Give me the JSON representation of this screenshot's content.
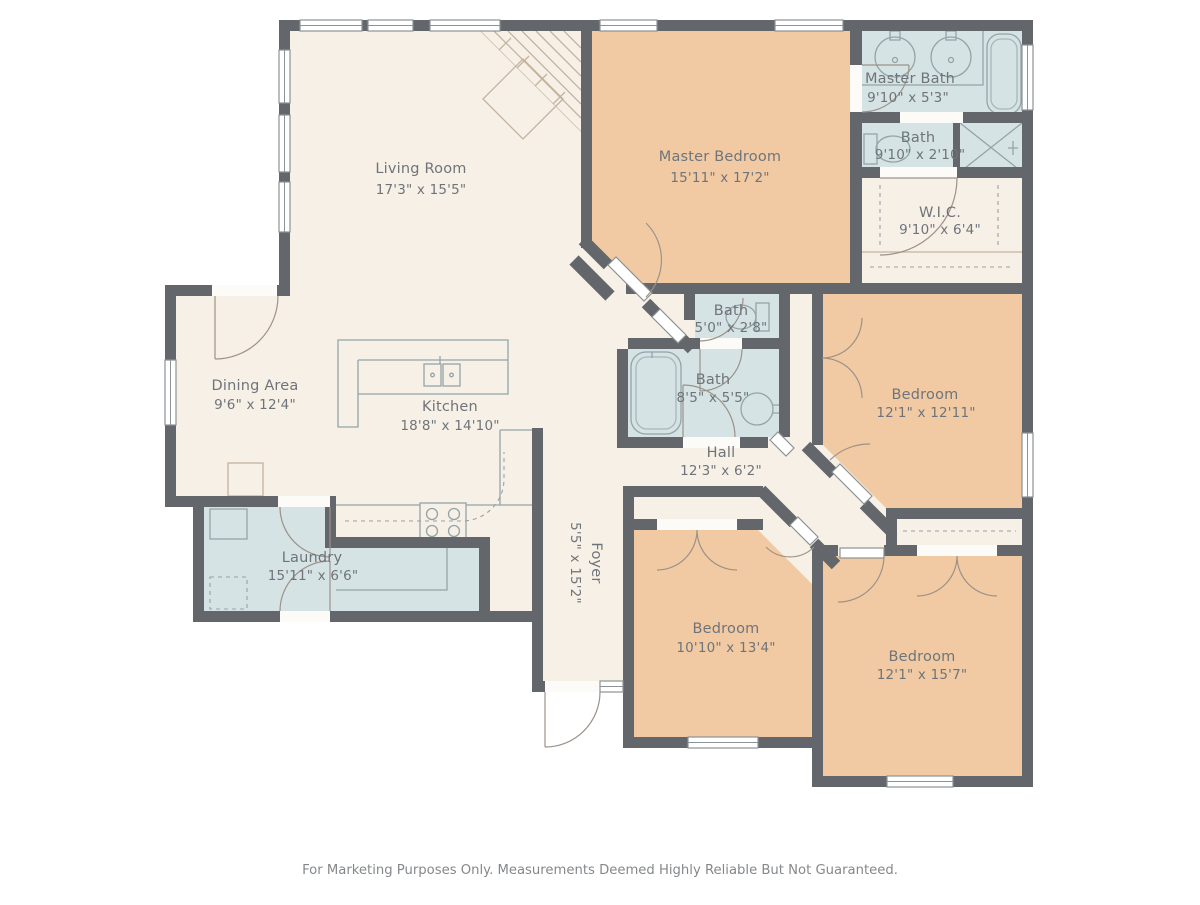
{
  "colors": {
    "wall": "#63676b",
    "floor_cream": "#f7f0e7",
    "floor_tan": "#f1caa3",
    "floor_blue": "#d5e3e5",
    "fixture_line": "#93a4a8",
    "fixture_line_warm": "#c3b39e",
    "label": "#6f747a",
    "footer": "#85888b",
    "door_arc": "#9c9289"
  },
  "footer": {
    "disclaimer": "For Marketing Purposes Only. Measurements Deemed Highly Reliable But Not Guaranteed."
  },
  "rooms": {
    "living": {
      "name": "Living Room",
      "dims": "17'3\" x 15'5\""
    },
    "master_bedroom": {
      "name": "Master Bedroom",
      "dims": "15'11\" x 17'2\""
    },
    "master_bath": {
      "name": "Master Bath",
      "dims": "9'10\" x 5'3\""
    },
    "bath_upper": {
      "name": "Bath",
      "dims": "9'10\" x 2'10\""
    },
    "wic": {
      "name": "W.I.C.",
      "dims": "9'10\" x 6'4\""
    },
    "bath_small": {
      "name": "Bath",
      "dims": "5'0\" x 2'8\""
    },
    "bath_hall": {
      "name": "Bath",
      "dims": "8'5\" x 5'5\""
    },
    "bedroom_right": {
      "name": "Bedroom",
      "dims": "12'1\" x 12'11\""
    },
    "dining": {
      "name": "Dining Area",
      "dims": "9'6\" x 12'4\""
    },
    "kitchen": {
      "name": "Kitchen",
      "dims": "18'8\" x 14'10\""
    },
    "hall": {
      "name": "Hall",
      "dims": "12'3\" x 6'2\""
    },
    "laundry": {
      "name": "Laundry",
      "dims": "15'11\" x 6'6\""
    },
    "foyer": {
      "name": "Foyer",
      "dims": "5'5\" x 15'2\""
    },
    "bedroom_middle": {
      "name": "Bedroom",
      "dims": "10'10\" x 13'4\""
    },
    "bedroom_bottom": {
      "name": "Bedroom",
      "dims": "12'1\" x 15'7\""
    }
  }
}
